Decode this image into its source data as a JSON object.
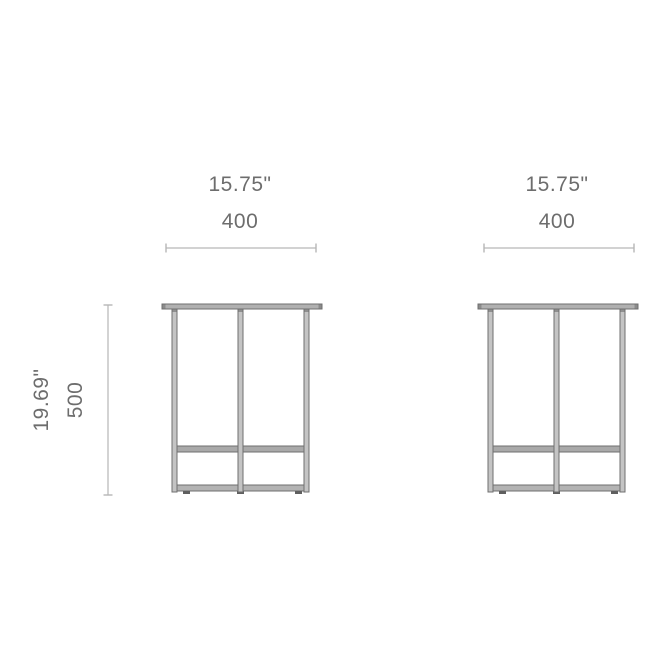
{
  "figures": [
    {
      "width_in": "15.75\"",
      "width_mm": "400",
      "height_in": "19.69\"",
      "height_mm": "500"
    },
    {
      "width_in": "15.75\"",
      "width_mm": "400"
    }
  ],
  "colors": {
    "background": "#ffffff",
    "label_text": "#6d6d6d",
    "dimension_line": "#b6b6b6",
    "frame_outline": "#6f6f6f",
    "frame_fill": "#c4c4c4",
    "foot": "#5f5f5f"
  }
}
